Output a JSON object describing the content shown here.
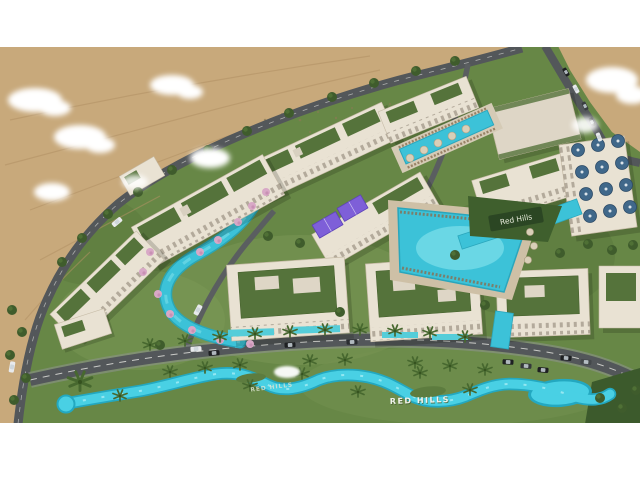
{
  "scene": {
    "description": "Aerial 3D architectural rendering of the Red Hills resort residential development: white apartment blocks with roof gardens, lagoon pools, a winding lazy river, desert dunes and clouds",
    "signs": {
      "building_sign": "Red Hills",
      "river_sign_primary": "RED HILLS",
      "river_sign_secondary": "RED HILLS"
    },
    "colors": {
      "letterbox": "#ffffff",
      "sand": "#c8a97b",
      "sand_ripple": "#b29164",
      "grass": "#678746",
      "grass_light": "#8fa763",
      "grass_dark": "#46622f",
      "road": "#53575a",
      "road_edge": "#8f9492",
      "road_marking": "#e8e8e4",
      "river": "#49d0e4",
      "river_deep": "#23a8c0",
      "pool": "#3cc2d8",
      "pool_light": "#7adeea",
      "deck": "#cec0a6",
      "building": "#e9e2d3",
      "building_trim": "#c6bba6",
      "window": "#7d7264",
      "roof_garden": "#55733b",
      "padel_court": "#7e5fd8",
      "umbrella_blue": "#40688a",
      "parasol_cream": "#d9cfb8",
      "flower_pink": "#d8a8c6",
      "tree_green": "#3f5c2c",
      "palm_green": "#47682f",
      "hillside": "#3f5f2d",
      "sign_bg": "#2a4423",
      "sign_text": "#e8ecdc",
      "river_letters": "#f2f4ee",
      "car_dark": "#1e2022",
      "car_white": "#e8eaec",
      "cloud": "#ffffff"
    }
  }
}
